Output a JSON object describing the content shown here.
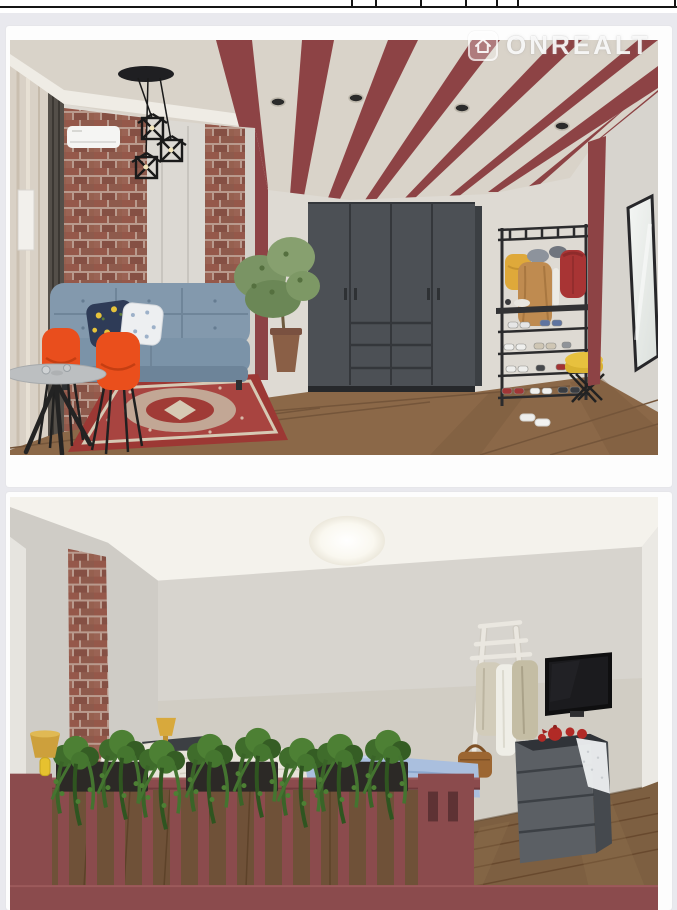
{
  "watermark": {
    "brand": "ONREALT",
    "icon": "house-icon"
  },
  "gallery": {
    "images": [
      {
        "name": "living-room-render",
        "objects": [
          "maroon striped beam ceiling",
          "cube wire pendant lights",
          "recessed spotlights",
          "brick wall",
          "air conditioner",
          "blue tufted sofa",
          "lemon print pillow",
          "white floral pillow",
          "two orange shell chairs",
          "round grey table",
          "red oriental rug",
          "dark grey wardrobe",
          "potted plant",
          "black coat rack with clothes and shoe shelves",
          "yellow stool",
          "leaning mirror",
          "wood plank floor"
        ]
      },
      {
        "name": "bedroom-render",
        "objects": [
          "round ceiling light",
          "brick wall strip",
          "bed with white linens",
          "blue folded blanket",
          "yellow table lamps",
          "dark bedside shelf",
          "maroon balcony railing with balusters",
          "planter boxes with hanging plants",
          "white ladder clothes rack",
          "hanging clothes",
          "brown handbag",
          "wall mounted tv",
          "grey chest of drawers",
          "red teapot set",
          "white lace runner",
          "wood plank floor"
        ]
      }
    ]
  },
  "colors": {
    "pageBg": "#e9e9ee",
    "card": "#fdfdfd",
    "tableLine": "#151515",
    "maroon": "#8d4345",
    "railing": "#8b4b4d",
    "ceilingCream": "#d9d3c9",
    "wallLight": "#dedad3",
    "brick": "#95584a",
    "mortar": "#b99a8d",
    "wood": "#8b6848",
    "woodBedroom": "#7d5f41",
    "sofaBlue": "#8399ad",
    "chairOrange": "#e94e1d",
    "wardrobeGrey": "#4c5055",
    "rugRed": "#9c3834",
    "accentYellow": "#e7c13e",
    "rackMetal": "#2b2b2d",
    "linen": "#e8e4da",
    "blanketBlue": "#aabfde",
    "plantGreen": "#4d8034",
    "dresserGrey": "#5b5f64",
    "tvBlack": "#0f0f10",
    "teapotRed": "#b12a26"
  }
}
